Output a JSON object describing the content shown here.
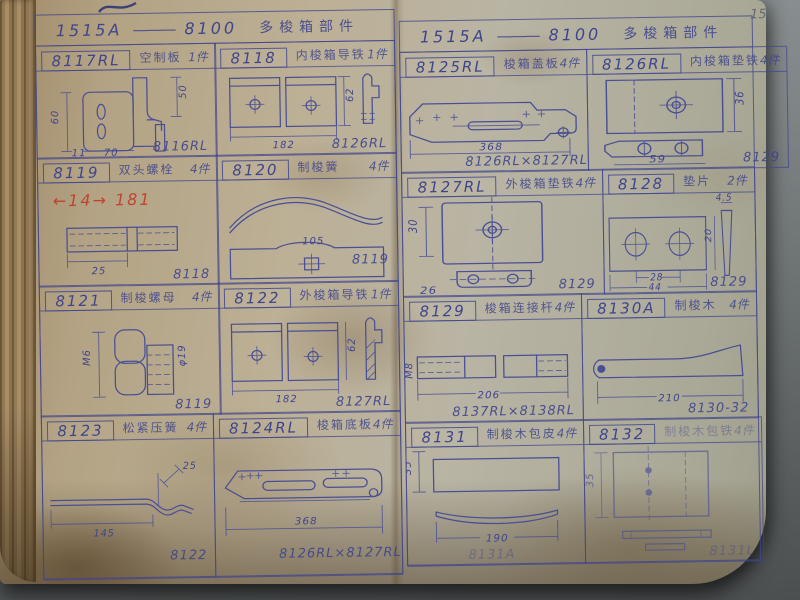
{
  "meta": {
    "page_number": "15"
  },
  "colors": {
    "ink": "#4a4f95",
    "red_note": "#c23b28",
    "paper": "#b5ab92",
    "backdrop": "#6f7576"
  },
  "pages": [
    {
      "side": "left",
      "header": {
        "model": "1515A",
        "dash": "———",
        "group": "8100",
        "title": "多梭箱部件"
      },
      "cells": [
        {
          "id": "8117RL",
          "name": "空制板",
          "qty": "1件",
          "corner": "8116RL",
          "dims": {
            "d1": "50",
            "d2": "60",
            "d3": "11",
            "d4": "70"
          }
        },
        {
          "id": "8118",
          "name": "内梭箱导铁",
          "qty": "1件",
          "corner": "8126RL",
          "dims": {
            "d1": "182",
            "d2": "62"
          }
        },
        {
          "id": "8119",
          "name": "双头螺栓",
          "qty": "4件",
          "corner": "8118",
          "note": "←14→ 181",
          "dims": {
            "d1": "25"
          }
        },
        {
          "id": "8120",
          "name": "制梭簧",
          "qty": "4件",
          "corner": "8119",
          "dims": {
            "d1": "105"
          }
        },
        {
          "id": "8121",
          "name": "制梭螺母",
          "qty": "4件",
          "corner": "8119",
          "dims": {
            "d1": "M6",
            "d2": "φ19"
          }
        },
        {
          "id": "8122",
          "name": "外梭箱导铁",
          "qty": "1件",
          "corner": "8127RL",
          "dims": {
            "d1": "182",
            "d2": "62"
          }
        },
        {
          "id": "8123",
          "name": "松紧压簧",
          "qty": "4件",
          "corner": "8122",
          "dims": {
            "d1": "145",
            "d2": "25"
          }
        },
        {
          "id": "8124RL",
          "name": "梭箱底板",
          "qty": "4件",
          "corner": "8126RL×8127RL",
          "dims": {
            "d1": "368"
          }
        }
      ]
    },
    {
      "side": "right",
      "header": {
        "model": "1515A",
        "dash": "———",
        "group": "8100",
        "title": "多梭箱部件"
      },
      "cells": [
        {
          "id": "8125RL",
          "name": "梭箱盖板",
          "qty": "4件",
          "corner": "8126RL×8127RL",
          "dims": {
            "d1": "368"
          }
        },
        {
          "id": "8126RL",
          "name": "内梭箱垫铁",
          "qty": "4件",
          "corner": "8129",
          "dims": {
            "d1": "36",
            "d2": "59"
          }
        },
        {
          "id": "8127RL",
          "name": "外梭箱垫铁",
          "qty": "4件",
          "corner": "8129",
          "dims": {
            "d1": "30",
            "d2": "26"
          }
        },
        {
          "id": "8128",
          "name": "垫片",
          "qty": "2件",
          "corner": "8129",
          "dims": {
            "d1": "4.5",
            "d2": "20",
            "d3": "28",
            "d4": "44"
          }
        },
        {
          "id": "8129",
          "name": "梭箱连接杆",
          "qty": "4件",
          "corner": "8137RL×8138RL",
          "dims": {
            "d1": "M8",
            "d2": "206"
          }
        },
        {
          "id": "8130A",
          "name": "制梭木",
          "qty": "4件",
          "corner": "8130-32",
          "dims": {
            "d1": "210"
          }
        },
        {
          "id": "8131",
          "name": "制梭木包皮",
          "qty": "4件",
          "corner": "8131A",
          "dims": {
            "d1": "35",
            "d2": "190"
          }
        },
        {
          "id": "8132",
          "name": "制梭木包铁",
          "qty": "4件",
          "corner": "8131L",
          "dims": {
            "d1": "35"
          }
        }
      ]
    }
  ]
}
